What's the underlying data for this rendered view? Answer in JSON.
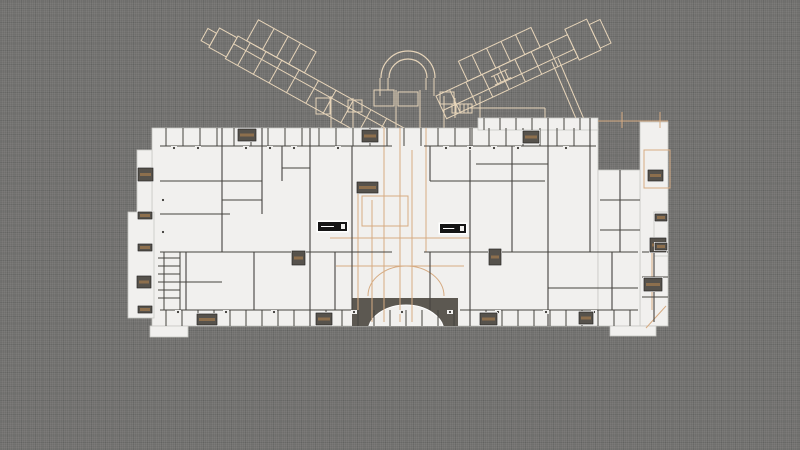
{
  "app": {
    "background_color": "#6f6e6c",
    "drawing_type": "floor-plan"
  },
  "palette": {
    "background": "#6f6e6c",
    "paper": "#f1f0ee",
    "paper_edge": "#c9c8c4",
    "wall": "#45433f",
    "cream": "#e6d4b9",
    "tan": "#d6ab82",
    "block": "#56524c",
    "block_stripe": "#8d6f4d",
    "block_edge": "#2f2d2a",
    "stair_black": "#151515",
    "apse_dark": "#5c5851",
    "door_dot": "#3a3834",
    "white": "#ffffff"
  },
  "plan": {
    "masses": [
      [
        152,
        128,
        446,
        198
      ],
      [
        478,
        118,
        120,
        12
      ],
      [
        640,
        122,
        28,
        204
      ],
      [
        598,
        170,
        42,
        156
      ],
      [
        137,
        150,
        15,
        64
      ],
      [
        128,
        212,
        26,
        106
      ],
      [
        654,
        212,
        14,
        44
      ],
      [
        150,
        326,
        38,
        11
      ],
      [
        610,
        326,
        46,
        10
      ]
    ],
    "walls": [
      [
        160,
        146,
        392,
        146
      ],
      [
        424,
        146,
        596,
        146
      ],
      [
        160,
        181,
        262,
        181
      ],
      [
        282,
        168,
        310,
        168
      ],
      [
        430,
        181,
        545,
        181
      ],
      [
        476,
        164,
        548,
        164
      ],
      [
        160,
        214,
        230,
        214
      ],
      [
        222,
        200,
        262,
        200
      ],
      [
        160,
        252,
        392,
        252
      ],
      [
        424,
        252,
        638,
        252
      ],
      [
        176,
        282,
        222,
        282
      ],
      [
        548,
        288,
        638,
        288
      ],
      [
        160,
        310,
        352,
        310
      ],
      [
        460,
        310,
        638,
        310
      ],
      [
        642,
        252,
        668,
        252
      ],
      [
        642,
        277,
        668,
        277
      ],
      [
        642,
        297,
        668,
        297
      ],
      [
        600,
        200,
        640,
        200
      ],
      [
        600,
        230,
        640,
        230
      ],
      [
        222,
        128,
        222,
        252
      ],
      [
        262,
        128,
        262,
        214
      ],
      [
        282,
        146,
        282,
        181
      ],
      [
        310,
        128,
        310,
        326
      ],
      [
        335,
        252,
        335,
        310
      ],
      [
        352,
        146,
        352,
        310
      ],
      [
        430,
        146,
        430,
        181
      ],
      [
        430,
        252,
        430,
        310
      ],
      [
        470,
        128,
        470,
        326
      ],
      [
        512,
        146,
        512,
        252
      ],
      [
        548,
        118,
        548,
        326
      ],
      [
        590,
        118,
        590,
        252
      ],
      [
        612,
        252,
        612,
        310
      ],
      [
        186,
        252,
        186,
        310
      ],
      [
        254,
        252,
        254,
        310
      ],
      [
        654,
        252,
        654,
        322
      ],
      [
        620,
        170,
        620,
        252
      ]
    ],
    "tan_lines": [
      [
        358,
        185,
        358,
        322
      ],
      [
        372,
        200,
        372,
        322
      ],
      [
        384,
        128,
        384,
        322
      ],
      [
        400,
        128,
        400,
        322
      ],
      [
        412,
        150,
        412,
        322
      ],
      [
        426,
        128,
        426,
        252
      ],
      [
        330,
        238,
        470,
        238
      ],
      [
        336,
        266,
        464,
        266
      ],
      [
        598,
        121,
        668,
        121
      ],
      [
        622,
        112,
        622,
        128
      ],
      [
        660,
        112,
        660,
        128
      ],
      [
        652,
        240,
        652,
        310
      ],
      [
        646,
        328,
        666,
        306
      ]
    ],
    "tan_rects": [
      [
        362,
        196,
        46,
        30
      ],
      [
        644,
        150,
        26,
        38
      ]
    ],
    "tan_arcs": [
      "M 368 296 A 38 30 0 0 1 444 296"
    ],
    "cream_lines": [
      [
        331,
        96,
        331,
        128
      ],
      [
        353,
        98,
        353,
        128
      ],
      [
        444,
        96,
        444,
        128
      ],
      [
        455,
        98,
        455,
        118
      ],
      [
        480,
        96,
        480,
        118
      ],
      [
        470,
        108,
        545,
        108
      ],
      [
        545,
        108,
        545,
        118
      ],
      [
        380,
        78,
        380,
        96
      ],
      [
        434,
        78,
        434,
        96
      ],
      [
        388,
        78,
        388,
        90
      ],
      [
        426,
        78,
        426,
        90
      ],
      [
        396,
        90,
        396,
        128
      ],
      [
        420,
        90,
        420,
        128
      ],
      [
        558,
        58,
        586,
        124
      ],
      [
        552,
        62,
        580,
        128
      ]
    ],
    "cream_rects": [
      [
        374,
        90,
        20,
        16
      ],
      [
        398,
        92,
        20,
        14
      ],
      [
        348,
        100,
        14,
        12
      ],
      [
        440,
        92,
        14,
        12
      ],
      [
        316,
        98,
        14,
        16
      ],
      [
        452,
        104,
        20,
        9
      ]
    ],
    "cream_arcs": [
      "M 381 78 A 27 27 0 0 1 435 78",
      "M 389 78 A 19 19 0 0 1 427 78"
    ],
    "tick_rows": [
      {
        "dir": "v",
        "a1": 128,
        "a2": 146,
        "from": 166,
        "to": 590,
        "step": 17,
        "stroke": "wall"
      },
      {
        "dir": "v",
        "a1": 118,
        "a2": 130,
        "from": 484,
        "to": 594,
        "step": 16,
        "stroke": "wall"
      },
      {
        "dir": "v",
        "a1": 310,
        "a2": 326,
        "from": 166,
        "to": 634,
        "step": 16,
        "stroke": "wall"
      },
      {
        "dir": "h",
        "a1": 158,
        "a2": 180,
        "from": 258,
        "to": 300,
        "step": 8,
        "stroke": "wall"
      },
      {
        "dir": "v",
        "a1": 104,
        "a2": 113,
        "from": 456,
        "to": 468,
        "step": 4,
        "stroke": "cream"
      },
      {
        "dir": "v",
        "a1": 252,
        "a2": 310,
        "from": 164,
        "to": 180,
        "step": 16,
        "stroke": "wall"
      }
    ],
    "door_dots": [
      [
        174,
        148
      ],
      [
        198,
        148
      ],
      [
        246,
        148
      ],
      [
        270,
        148
      ],
      [
        294,
        148
      ],
      [
        338,
        148
      ],
      [
        446,
        148
      ],
      [
        470,
        148
      ],
      [
        494,
        148
      ],
      [
        518,
        148
      ],
      [
        566,
        148
      ],
      [
        178,
        312
      ],
      [
        226,
        312
      ],
      [
        274,
        312
      ],
      [
        354,
        312
      ],
      [
        402,
        312
      ],
      [
        450,
        312
      ],
      [
        498,
        312
      ],
      [
        546,
        312
      ],
      [
        594,
        312
      ],
      [
        163,
        200
      ],
      [
        163,
        232
      ]
    ],
    "blocks": [
      [
        238,
        129,
        18,
        12
      ],
      [
        362,
        130,
        16,
        12
      ],
      [
        523,
        131,
        16,
        12
      ],
      [
        138,
        168,
        15,
        13
      ],
      [
        357,
        182,
        21,
        11
      ],
      [
        648,
        170,
        15,
        11
      ],
      [
        292,
        251,
        13,
        14
      ],
      [
        489,
        249,
        12,
        16
      ],
      [
        137,
        276,
        14,
        12
      ],
      [
        644,
        278,
        18,
        13
      ],
      [
        650,
        238,
        16,
        14
      ],
      [
        197,
        314,
        20,
        11
      ],
      [
        316,
        313,
        16,
        12
      ],
      [
        480,
        313,
        17,
        12
      ],
      [
        579,
        312,
        14,
        12
      ],
      [
        138,
        212,
        14,
        7
      ],
      [
        138,
        244,
        14,
        7
      ],
      [
        138,
        306,
        14,
        7
      ],
      [
        655,
        214,
        12,
        7
      ],
      [
        655,
        243,
        12,
        7
      ]
    ],
    "stairs": [
      [
        318,
        222,
        29,
        9
      ],
      [
        440,
        224,
        26,
        9
      ]
    ],
    "apse": {
      "band": [
        352,
        298,
        106,
        28
      ],
      "dome": [
        406,
        332,
        38,
        27
      ]
    },
    "wing_left": {
      "origin": [
        238,
        36
      ],
      "rotate": 29,
      "rects": [
        [
          0,
          0,
          190,
          26
        ],
        [
          10,
          -24,
          66,
          24
        ],
        [
          -20,
          2,
          20,
          22
        ],
        [
          -30,
          8,
          10,
          14
        ]
      ],
      "lines": [
        [
          0,
          9,
          190,
          9
        ],
        [
          14,
          0,
          14,
          26
        ],
        [
          32,
          0,
          32,
          26
        ],
        [
          50,
          0,
          50,
          26
        ],
        [
          70,
          0,
          70,
          26
        ],
        [
          92,
          0,
          92,
          26
        ],
        [
          112,
          0,
          112,
          26
        ],
        [
          132,
          0,
          132,
          26
        ],
        [
          152,
          0,
          152,
          26
        ],
        [
          170,
          0,
          170,
          26
        ],
        [
          28,
          -24,
          28,
          0
        ],
        [
          44,
          -24,
          44,
          0
        ],
        [
          58,
          -24,
          58,
          0
        ]
      ]
    },
    "wing_right": {
      "origin": [
        436,
        96
      ],
      "rotate": -25,
      "rects": [
        [
          0,
          0,
          145,
          25
        ],
        [
          35,
          -22,
          80,
          22
        ],
        [
          145,
          -6,
          24,
          34
        ],
        [
          169,
          0,
          12,
          26
        ]
      ],
      "lines": [
        [
          0,
          16,
          145,
          16
        ],
        [
          15,
          0,
          15,
          25
        ],
        [
          33,
          0,
          33,
          25
        ],
        [
          51,
          0,
          51,
          25
        ],
        [
          69,
          0,
          69,
          25
        ],
        [
          87,
          0,
          87,
          25
        ],
        [
          105,
          0,
          105,
          25
        ],
        [
          123,
          0,
          123,
          25
        ],
        [
          50,
          -22,
          50,
          0
        ],
        [
          66,
          -22,
          66,
          0
        ],
        [
          82,
          -22,
          82,
          0
        ],
        [
          98,
          -22,
          98,
          0
        ],
        [
          58,
          6,
          76,
          6
        ],
        [
          58,
          15,
          76,
          15
        ],
        [
          61,
          6,
          61,
          15
        ],
        [
          65,
          6,
          65,
          15
        ],
        [
          69,
          6,
          69,
          15
        ],
        [
          73,
          6,
          73,
          15
        ]
      ]
    }
  }
}
